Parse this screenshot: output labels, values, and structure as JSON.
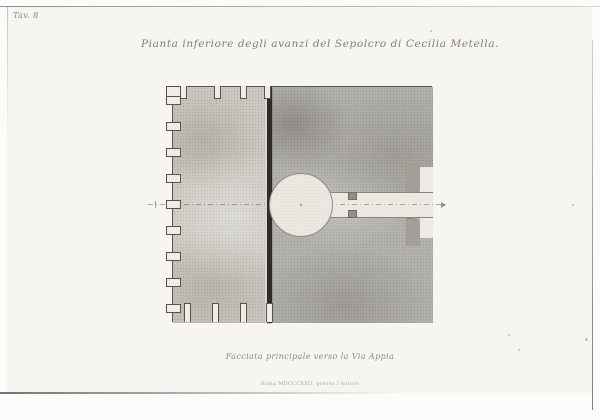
{
  "plate": {
    "number_label": "Tav. 8",
    "title": "Pianta inferiore degli avanzi del Sepolcro di Cecilia Metella.",
    "caption": "Facciata principale verso la Via Appia",
    "imprint": "Roma MDCCCXXII. presso l'Autore",
    "colors": {
      "paper": "#f6f5f1",
      "margin": "#fbfbf9",
      "ink": "#807e75",
      "core_fill": "#cbc8c1",
      "outer_fill": "#b3b1ac",
      "chamber_fill": "#eae8e1",
      "divider_wall": "#2e2c29",
      "outline": "#56544e"
    },
    "plan": {
      "square": {
        "left": 172,
        "top": 86,
        "width": 260,
        "height": 236
      },
      "divider": {
        "x": 266,
        "width": 5
      },
      "chamber": {
        "cx": 300,
        "cy": 204,
        "r": 32
      },
      "corridor": {
        "x": 330,
        "y": 191,
        "width": 102,
        "height": 26
      },
      "recess": {
        "x": 419,
        "y": 166,
        "width": 13,
        "height": 71
      },
      "pier_blocks": [
        {
          "x": 405,
          "y": 162,
          "w": 14,
          "h": 29,
          "side": "top"
        },
        {
          "x": 405,
          "y": 217,
          "w": 14,
          "h": 27,
          "side": "bot"
        }
      ],
      "jambs": [
        {
          "x": 347,
          "y": 191,
          "w": 9,
          "h": 8
        },
        {
          "x": 347,
          "y": 209,
          "w": 9,
          "h": 8
        }
      ],
      "corner_notch": {
        "x": 166,
        "y": 86,
        "w": 16,
        "h": 12
      },
      "left_tabs_y": [
        100,
        126,
        152,
        178,
        204,
        230,
        256,
        282,
        308
      ],
      "tab_size": {
        "w": 15,
        "h": 9,
        "overhang": 7
      },
      "top_slots_x": [
        183,
        217,
        243,
        267
      ],
      "top_slot_size": {
        "w": 7,
        "h": 13
      },
      "bottom_slots_x": [
        187,
        215,
        243,
        269
      ],
      "bottom_slot_size": {
        "w": 7,
        "h": 19
      },
      "axis": {
        "y": 204,
        "x1": 148,
        "x2": 446,
        "tick_x": 155,
        "arrow_x": 441
      }
    },
    "specks": [
      {
        "x": 430,
        "y": 30,
        "s": 2
      },
      {
        "x": 508,
        "y": 334,
        "s": 2
      },
      {
        "x": 518,
        "y": 349,
        "s": 2
      },
      {
        "x": 585,
        "y": 338,
        "s": 3
      },
      {
        "x": 572,
        "y": 204,
        "s": 2
      }
    ]
  }
}
